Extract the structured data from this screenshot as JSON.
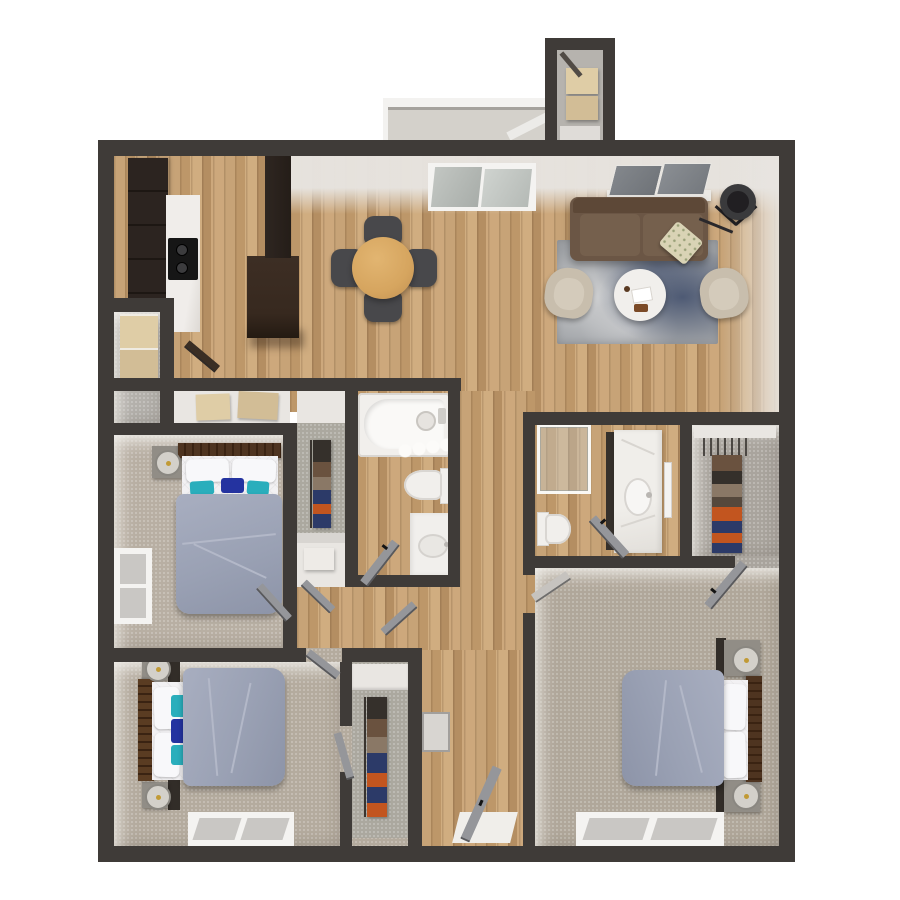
{
  "meta": {
    "title": "3D apartment floor plan, top-down render",
    "canvas": {
      "width": 900,
      "height": 900
    },
    "visible_text": []
  },
  "palette": {
    "wall": "#3f3b38",
    "wallLight": "#d8d5d1",
    "woodA": "#c7a377",
    "woodB": "#bd9769",
    "woodC": "#d0ad80",
    "woodD": "#b48e62",
    "woodE": "#cda87c",
    "carpet1": "#b8afa3",
    "carpet2": "#b4ab9e",
    "carpet3": "#b0a79a",
    "carpetGray": "#b3b0ab",
    "carpetCloset": "#a9a49d",
    "closetInner": "#aba89f",
    "cream": "#e9e6e2",
    "white1": "#f2f0ed",
    "balconyFloor": "#d4d1cb",
    "railLine": "#a5a29d",
    "storageFloor": "#b6b3ae",
    "cabinetDark": "#2c2420",
    "islandDark": "#37291f",
    "stove": "#161616",
    "counter": "#f0edea",
    "lightWoodBox": "#dfcda6",
    "lightWoodBox2": "#d2bd96",
    "duvet": "#9aa1b4",
    "duvetCrease": "#b3b8c8",
    "sheet": "#f2f1f3",
    "teal": "#2aaebc",
    "navy": "#2433a0",
    "headboard": "#4e3420",
    "nightstand": "#918d86",
    "nightstandDark": "#322d28",
    "lampBase": "#d3d0ca",
    "sofa": "#6b5645",
    "sofaBack": "#5d4837",
    "sofaCushion": "#75604d",
    "throwPillow": "#d9d3b5",
    "armchair": "#c8bead",
    "armchairSeat": "#d4cbbb",
    "diningTable": "#d6a55f",
    "diningTableEdge": "#c19052",
    "chair": "#48484b",
    "rugBase": "#9fa2a6",
    "rugNavy": "#55617c",
    "rugDark": "#46536f",
    "tvFrame": "#ebe9e5",
    "tvGlass": "#6f7378",
    "lampShade": "#3a3a3c",
    "lampInner": "#211f22",
    "fixture": "#f1efec",
    "fixtureShadow": "#d9d6d2",
    "glassTint": "#c9d2d5",
    "doorGray": "#95969a",
    "clothesDark": "#35302b",
    "clothesBrown": "#6a523f",
    "clothesTan": "#8a7866",
    "clothesNavy": "#2c3a68",
    "clothesOrange": "#c2551f",
    "entryMat": "#f0eeea",
    "windowPane": "#c9c7c4",
    "windowFrame": "#f4f3f1"
  },
  "rooms": [
    {
      "id": "kitchen",
      "name": "Kitchen",
      "floor": "wood"
    },
    {
      "id": "dining-area",
      "name": "Dining area",
      "floor": "wood"
    },
    {
      "id": "living-room",
      "name": "Living room",
      "floor": "wood"
    },
    {
      "id": "balcony",
      "name": "Balcony / patio",
      "floor": "concrete"
    },
    {
      "id": "storage-closet",
      "name": "Exterior storage closet",
      "floor": "carpet-gray"
    },
    {
      "id": "laundry-closet",
      "name": "Laundry / utility closet",
      "floor": "carpet-gray"
    },
    {
      "id": "linen-closet-1",
      "name": "Linen closet",
      "floor": "carpet-gray"
    },
    {
      "id": "bedroom-1",
      "name": "Bedroom 1 (left)",
      "floor": "carpet"
    },
    {
      "id": "bedroom-1-closet",
      "name": "Bedroom 1 closet",
      "floor": "carpet-gray"
    },
    {
      "id": "bathroom-1",
      "name": "Hall bathroom",
      "floor": "wood"
    },
    {
      "id": "hallway",
      "name": "Hallway",
      "floor": "wood"
    },
    {
      "id": "entry-hall",
      "name": "Entry hall",
      "floor": "wood"
    },
    {
      "id": "bedroom-2",
      "name": "Bedroom 2 (bottom-left)",
      "floor": "carpet"
    },
    {
      "id": "bedroom-2-closet",
      "name": "Bedroom 2 closet",
      "floor": "carpet-gray"
    },
    {
      "id": "bathroom-2",
      "name": "En-suite bathroom",
      "floor": "wood"
    },
    {
      "id": "walk-in-closet",
      "name": "Walk-in closet",
      "floor": "carpet-gray"
    },
    {
      "id": "master-bedroom",
      "name": "Master bedroom (bottom-right)",
      "floor": "carpet"
    }
  ],
  "furniture": [
    {
      "room": "kitchen",
      "items": [
        "tall dark cabinets",
        "white marble counter",
        "black cooktop",
        "kitchen island",
        "cabinet column"
      ]
    },
    {
      "room": "laundry-closet",
      "items": [
        "stacked washer-dryer / wood cabinets"
      ]
    },
    {
      "room": "dining-area",
      "items": [
        "round oak dining table",
        "4 dark gray chairs"
      ]
    },
    {
      "room": "living-room",
      "items": [
        "brown sofa",
        "floral throw pillow",
        "flat TV on media base",
        "black tripod floor lamp",
        "gray-navy area rug",
        "round white coffee table",
        "2 tan armchairs",
        "sliding patio door"
      ]
    },
    {
      "room": "balcony",
      "items": [
        "white railing",
        "privacy panel"
      ]
    },
    {
      "room": "storage-closet",
      "items": [
        "wood shelf boxes",
        "white shelf"
      ]
    },
    {
      "room": "bedroom-1",
      "items": [
        "bed: wood headboard, white pillows, teal+navy accents, gray-blue duvet",
        "nightstand with round lamp",
        "left wall window"
      ]
    },
    {
      "room": "bedroom-1-closet",
      "items": [
        "hanging clothes: dark/brown/tan/navy/orange",
        "white shelf box"
      ]
    },
    {
      "room": "bathroom-1",
      "items": [
        "bathtub with shower head",
        "shower curtain",
        "toilet",
        "vanity with oval sink",
        "door"
      ]
    },
    {
      "room": "bedroom-2",
      "items": [
        "bed (headboard left)",
        "2 nightstands with round lamps",
        "bottom wall window",
        "closet with hanging clothes"
      ]
    },
    {
      "room": "bathroom-2",
      "items": [
        "glass shower enclosure",
        "toilet",
        "marble vanity with sink",
        "mirror",
        "door"
      ]
    },
    {
      "room": "walk-in-closet",
      "items": [
        "white shelf",
        "hanger rod",
        "hanging clothes browns/orange/navy"
      ]
    },
    {
      "room": "master-bedroom",
      "items": [
        "bed (headboard right)",
        "2 nightstands with round lamps",
        "bottom wall window",
        "doors"
      ]
    },
    {
      "room": "entry-hall",
      "items": [
        "entry door (open)",
        "white entry mat"
      ]
    }
  ]
}
